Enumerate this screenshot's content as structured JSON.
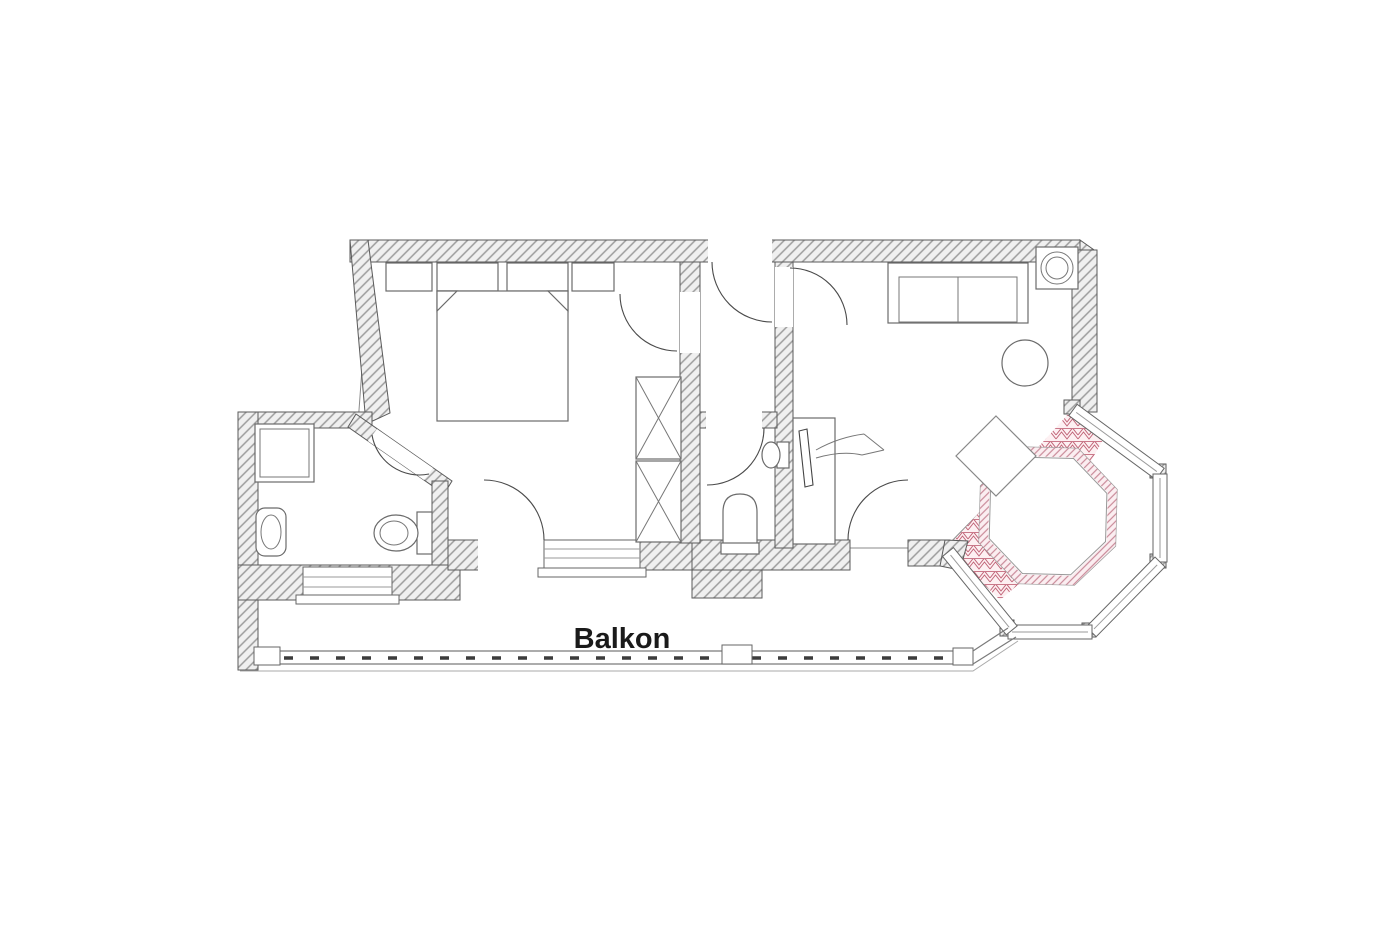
{
  "plan": {
    "balcony": {
      "label": "Balkon"
    },
    "palette": {
      "wall_hatch": "#9c9c9c",
      "wall_fill": "#f0f0f0",
      "bedroom_floor": "#c8a45a",
      "bedroom_floor_bg": "#fbf5ea",
      "living_floor": "#c16478",
      "living_floor_bg": "#fdf0f2",
      "bath_floor": "#5555c0",
      "bath_floor_bg": "#f3f4fb",
      "hall_floor": "#c8c83c",
      "hall_floor_bg": "#fbfbe9",
      "table_trim": "#c98a99",
      "table_trim_bg": "#fbeef1",
      "label_color": "#1a1a1a"
    },
    "rooms": [
      {
        "id": "bedroom",
        "floor_pattern": "tan-herringbone"
      },
      {
        "id": "bathroom",
        "floor_pattern": "blue-crosshatch"
      },
      {
        "id": "hallway",
        "floor_pattern": "yellow-diamond"
      },
      {
        "id": "wc",
        "floor_pattern": "blue-crosshatch"
      },
      {
        "id": "living-room",
        "floor_pattern": "red-herringbone"
      },
      {
        "id": "balcony",
        "floor_pattern": "none"
      }
    ],
    "furniture": {
      "bedroom": [
        "double-bed",
        "pillow-left",
        "pillow-right",
        "nightstand-left",
        "nightstand-right",
        "wardrobe-upper",
        "wardrobe-lower"
      ],
      "bathroom": [
        "shower",
        "washbasin",
        "toilet"
      ],
      "wc": [
        "toilet",
        "washbasin"
      ],
      "living_room": [
        "sofa",
        "corner-column",
        "round-table",
        "tv-panel",
        "chair",
        "bay-table"
      ],
      "balcony": [
        "railing",
        "posts"
      ]
    }
  }
}
